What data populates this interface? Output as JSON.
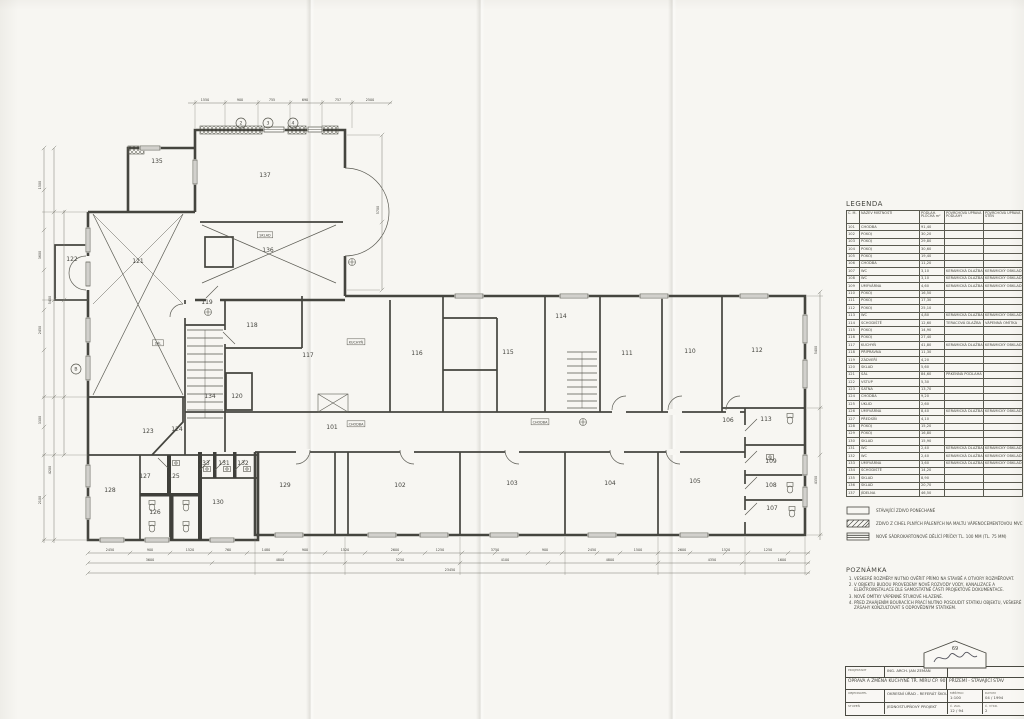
{
  "legend": {
    "title": "LEGENDA",
    "columns": [
      "Č. M.",
      "NÁZEV MÍSTNOSTI",
      "PODLAH. PLOCHA m²",
      "POVRCHOVÁ ÚPRAVA PODLAHY",
      "POVRCHOVÁ ÚPRAVA STĚN"
    ],
    "rows": [
      [
        "101",
        "CHODBA",
        "91,40",
        "",
        ""
      ],
      [
        "102",
        "POKOJ",
        "30,20",
        "",
        ""
      ],
      [
        "103",
        "POKOJ",
        "29,80",
        "",
        ""
      ],
      [
        "104",
        "POKOJ",
        "30,60",
        "",
        ""
      ],
      [
        "105",
        "POKOJ",
        "19,40",
        "",
        ""
      ],
      [
        "106",
        "CHODBA",
        "11,20",
        "",
        ""
      ],
      [
        "107",
        "WC",
        "3,10",
        "KERAMICKÁ DLAŽBA",
        "KERAMICKÝ OBKLAD"
      ],
      [
        "108",
        "WC",
        "3,10",
        "KERAMICKÁ DLAŽBA",
        "KERAMICKÝ OBKLAD"
      ],
      [
        "109",
        "UMÝVÁRNA",
        "4,60",
        "KERAMICKÁ DLAŽBA",
        "KERAMICKÝ OBKLAD"
      ],
      [
        "110",
        "POKOJ",
        "16,50",
        "",
        ""
      ],
      [
        "111",
        "POKOJ",
        "17,30",
        "",
        ""
      ],
      [
        "112",
        "POKOJ",
        "25,10",
        "",
        ""
      ],
      [
        "113",
        "WC",
        "4,80",
        "KERAMICKÁ DLAŽBA",
        "KERAMICKÝ OBKLAD"
      ],
      [
        "114",
        "SCHODIŠTĚ",
        "12,60",
        "TERACOVÁ DLAŽBA",
        "VÁPENNÁ OMÍTKA"
      ],
      [
        "115",
        "POKOJ",
        "14,90",
        "",
        ""
      ],
      [
        "116",
        "POKOJ",
        "27,40",
        "",
        ""
      ],
      [
        "117",
        "KUCHYŇ",
        "41,80",
        "KERAMICKÁ DLAŽBA",
        "KERAMICKÝ OBKLAD"
      ],
      [
        "118",
        "PŘÍPRAVNA",
        "11,30",
        "",
        ""
      ],
      [
        "119",
        "ZÁDVEŘÍ",
        "4,20",
        "",
        ""
      ],
      [
        "120",
        "SKLAD",
        "5,60",
        "",
        ""
      ],
      [
        "121",
        "SÁL",
        "84,60",
        "PRKENNÁ PODLAHA",
        ""
      ],
      [
        "122",
        "VSTUP",
        "5,30",
        "",
        ""
      ],
      [
        "123",
        "ŠATNA",
        "13,70",
        "",
        ""
      ],
      [
        "124",
        "CHODBA",
        "9,20",
        "",
        ""
      ],
      [
        "125",
        "ÚKLID",
        "2,60",
        "",
        ""
      ],
      [
        "126",
        "UMÝVÁRNA",
        "8,40",
        "KERAMICKÁ DLAŽBA",
        "KERAMICKÝ OBKLAD"
      ],
      [
        "127",
        "PŘEDSÍŇ",
        "4,10",
        "",
        ""
      ],
      [
        "128",
        "POKOJ",
        "15,20",
        "",
        ""
      ],
      [
        "129",
        "POKOJ",
        "16,80",
        "",
        ""
      ],
      [
        "130",
        "SKLAD",
        "15,90",
        "",
        ""
      ],
      [
        "131",
        "WC",
        "2,40",
        "KERAMICKÁ DLAŽBA",
        "KERAMICKÝ OBKLAD"
      ],
      [
        "132",
        "WC",
        "2,40",
        "KERAMICKÁ DLAŽBA",
        "KERAMICKÝ OBKLAD"
      ],
      [
        "133",
        "UMÝVÁRNA",
        "3,60",
        "KERAMICKÁ DLAŽBA",
        "KERAMICKÝ OBKLAD"
      ],
      [
        "134",
        "SCHODIŠTĚ",
        "14,20",
        "",
        ""
      ],
      [
        "135",
        "SKLAD",
        "8,90",
        "",
        ""
      ],
      [
        "136",
        "SKLAD",
        "20,70",
        "",
        ""
      ],
      [
        "137",
        "JÍDELNA",
        "46,50",
        "",
        ""
      ]
    ]
  },
  "symbols": [
    {
      "label": "STÁVAJÍCÍ ZDIVO PONECHANÉ"
    },
    {
      "label": "ZDIVO Z CIHEL PLNÝCH PÁLENÝCH NA MALTU VÁPENOCEMENTOVOU MVC 2,5"
    },
    {
      "label": "NOVÉ SÁDROKARTONOVÉ DĚLÍCÍ PŘÍČKY TL. 100 MM (TL. 75 MM)"
    }
  ],
  "notes": {
    "title": "POZNÁMKA",
    "items": [
      "VEŠKERÉ ROZMĚRY NUTNO OVĚŘIT PŘÍMO NA STAVBĚ A OTVORY ROZMĚŘOVAT.",
      "V OBJEKTU BUDOU PROVEDENY NOVÉ ROZVODY VODY, KANALIZACE A ELEKTROINSTALACE DLE SAMOSTATNÉ ČÁSTI PROJEKTOVÉ DOKUMENTACE.",
      "NOVÉ OMÍTKY VÁPENNÉ ŠTUKOVÉ HLAZENÉ.",
      "PŘED ZAHÁJENÍM BOURACÍCH PRACÍ NUTNO POSOUDIT STATIKU OBJEKTU, VEŠKERÉ ZÁSAHY KONZULTOVAT S ODPOVĚDNÝM STATIKEM."
    ]
  },
  "titleblock": {
    "projektant_label": "PROJEKTANT",
    "projektant": "ING. ARCH. JAN ZEMAN",
    "title": "OPRAVA A ZMĚNA KUCHYNĚ TŘ. MÍRU ČP. 90",
    "subtitle": "PŘÍZEMÍ - STÁVAJÍCÍ STAV",
    "objednatel_label": "OBJEDNATEL",
    "objednatel": "OKRESNÍ ÚŘAD - REFERÁT ŠKOLSTVÍ",
    "stupen_label": "STUPEŇ",
    "stupen": "JEDNOSTUPŇOVÝ PROJEKT",
    "meritko_label": "MĚŘÍTKO",
    "meritko": "1:100",
    "datum_label": "DATUM",
    "datum": "04 / 1994",
    "zak_label": "Č. ZAK.",
    "zak": "12 / 94",
    "vykres_label": "Č. VÝKR.",
    "vykres": "2"
  },
  "stamp": {
    "number": "69"
  },
  "plan": {
    "rooms": [
      {
        "n": "101",
        "x": 332,
        "y": 429
      },
      {
        "n": "102",
        "x": 400,
        "y": 487
      },
      {
        "n": "103",
        "x": 512,
        "y": 485
      },
      {
        "n": "104",
        "x": 610,
        "y": 485
      },
      {
        "n": "105",
        "x": 695,
        "y": 483
      },
      {
        "n": "106",
        "x": 728,
        "y": 422
      },
      {
        "n": "107",
        "x": 772,
        "y": 510
      },
      {
        "n": "108",
        "x": 771,
        "y": 487
      },
      {
        "n": "109",
        "x": 771,
        "y": 463
      },
      {
        "n": "110",
        "x": 690,
        "y": 353
      },
      {
        "n": "111",
        "x": 627,
        "y": 355
      },
      {
        "n": "112",
        "x": 757,
        "y": 352
      },
      {
        "n": "113",
        "x": 766,
        "y": 421
      },
      {
        "n": "114",
        "x": 561,
        "y": 318
      },
      {
        "n": "115",
        "x": 508,
        "y": 354
      },
      {
        "n": "116",
        "x": 417,
        "y": 355
      },
      {
        "n": "117",
        "x": 308,
        "y": 357
      },
      {
        "n": "118",
        "x": 252,
        "y": 327
      },
      {
        "n": "119",
        "x": 207,
        "y": 304
      },
      {
        "n": "120",
        "x": 237,
        "y": 398
      },
      {
        "n": "121",
        "x": 138,
        "y": 263
      },
      {
        "n": "122",
        "x": 72,
        "y": 261
      },
      {
        "n": "123",
        "x": 148,
        "y": 433
      },
      {
        "n": "124",
        "x": 177,
        "y": 431
      },
      {
        "n": "125",
        "x": 174,
        "y": 478
      },
      {
        "n": "126",
        "x": 155,
        "y": 514
      },
      {
        "n": "127",
        "x": 145,
        "y": 478
      },
      {
        "n": "128",
        "x": 110,
        "y": 492
      },
      {
        "n": "129",
        "x": 285,
        "y": 487
      },
      {
        "n": "130",
        "x": 218,
        "y": 504
      },
      {
        "n": "131",
        "x": 224,
        "y": 465
      },
      {
        "n": "132",
        "x": 243,
        "y": 465
      },
      {
        "n": "133",
        "x": 204,
        "y": 465
      },
      {
        "n": "134",
        "x": 210,
        "y": 398
      },
      {
        "n": "135",
        "x": 157,
        "y": 163
      },
      {
        "n": "136",
        "x": 268,
        "y": 252
      },
      {
        "n": "137",
        "x": 265,
        "y": 177
      }
    ],
    "boxed_labels": [
      {
        "t": "SKLAD",
        "x": 265,
        "y": 236
      },
      {
        "t": "SÁL",
        "x": 158,
        "y": 344
      },
      {
        "t": "KUCHYŇ",
        "x": 356,
        "y": 343
      },
      {
        "t": "CHODBA",
        "x": 356,
        "y": 425
      },
      {
        "t": "CHODBA",
        "x": 540,
        "y": 423
      }
    ],
    "grid_bubbles": [
      {
        "t": "2",
        "x": 241,
        "y": 123
      },
      {
        "t": "3",
        "x": 268,
        "y": 123
      },
      {
        "t": "4",
        "x": 293,
        "y": 123
      },
      {
        "t": "B",
        "x": 76,
        "y": 369
      }
    ],
    "dim_labels": [
      {
        "t": "1550",
        "x": 205,
        "y": 101
      },
      {
        "t": "900",
        "x": 240,
        "y": 101
      },
      {
        "t": "755",
        "x": 272,
        "y": 101
      },
      {
        "t": "690",
        "x": 305,
        "y": 101
      },
      {
        "t": "757",
        "x": 338,
        "y": 101
      },
      {
        "t": "2500",
        "x": 370,
        "y": 101
      },
      {
        "t": "2450",
        "x": 110,
        "y": 551
      },
      {
        "t": "900",
        "x": 150,
        "y": 551
      },
      {
        "t": "1520",
        "x": 190,
        "y": 551
      },
      {
        "t": "760",
        "x": 228,
        "y": 551
      },
      {
        "t": "1480",
        "x": 266,
        "y": 551
      },
      {
        "t": "900",
        "x": 305,
        "y": 551
      },
      {
        "t": "1520",
        "x": 345,
        "y": 551
      },
      {
        "t": "2600",
        "x": 395,
        "y": 551
      },
      {
        "t": "1250",
        "x": 440,
        "y": 551
      },
      {
        "t": "3750",
        "x": 495,
        "y": 551
      },
      {
        "t": "900",
        "x": 545,
        "y": 551
      },
      {
        "t": "2450",
        "x": 592,
        "y": 551
      },
      {
        "t": "1500",
        "x": 638,
        "y": 551
      },
      {
        "t": "2600",
        "x": 682,
        "y": 551
      },
      {
        "t": "1520",
        "x": 726,
        "y": 551
      },
      {
        "t": "1250",
        "x": 768,
        "y": 551
      },
      {
        "t": "3600",
        "x": 150,
        "y": 561
      },
      {
        "t": "4800",
        "x": 280,
        "y": 561
      },
      {
        "t": "5250",
        "x": 400,
        "y": 561
      },
      {
        "t": "4100",
        "x": 505,
        "y": 561
      },
      {
        "t": "4800",
        "x": 610,
        "y": 561
      },
      {
        "t": "4350",
        "x": 712,
        "y": 561
      },
      {
        "t": "1600",
        "x": 782,
        "y": 561
      },
      {
        "t": "23450",
        "x": 450,
        "y": 571
      },
      {
        "t": "1500",
        "x": 41,
        "y": 185,
        "r": 1
      },
      {
        "t": "3600",
        "x": 41,
        "y": 255,
        "r": 1
      },
      {
        "t": "2450",
        "x": 41,
        "y": 330,
        "r": 1
      },
      {
        "t": "3300",
        "x": 41,
        "y": 420,
        "r": 1
      },
      {
        "t": "2100",
        "x": 41,
        "y": 500,
        "r": 1
      },
      {
        "t": "5400",
        "x": 51,
        "y": 300,
        "r": 1
      },
      {
        "t": "4200",
        "x": 51,
        "y": 470,
        "r": 1
      },
      {
        "t": "5400",
        "x": 817,
        "y": 350,
        "r": 1
      },
      {
        "t": "4350",
        "x": 817,
        "y": 480,
        "r": 1
      },
      {
        "t": "5700",
        "x": 379,
        "y": 210,
        "r": 1
      }
    ]
  }
}
